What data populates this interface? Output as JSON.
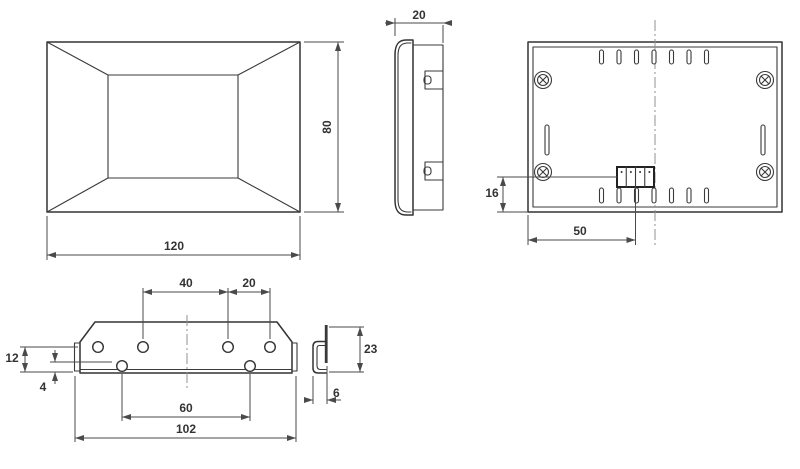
{
  "drawing": {
    "kind": "technical-dimension-drawing",
    "views": [
      "front-view",
      "side-view",
      "back-view",
      "bracket-front-view",
      "bracket-side-view"
    ]
  },
  "dimensions": {
    "front_width": "120",
    "front_height": "80",
    "side_depth": "20",
    "terminal_to_bottom": "16",
    "edge_to_terminal_center": "50",
    "bracket_upper_holes_span_left": "40",
    "bracket_upper_holes_span_right": "20",
    "bracket_edge_height": "12",
    "bracket_flange_height": "4",
    "bracket_lower_holes_span": "60",
    "bracket_total_width": "102",
    "bracket_clip_height": "23",
    "bracket_clip_depth": "6"
  },
  "icons": {
    "screw": "phillips-screw",
    "vent": "vent-slot",
    "terminal": "terminal-block-4-pole"
  },
  "colors": {
    "object_line": "#333333",
    "dimension_line": "#4a4a4a",
    "center_line": "#909090",
    "background": "#ffffff"
  }
}
